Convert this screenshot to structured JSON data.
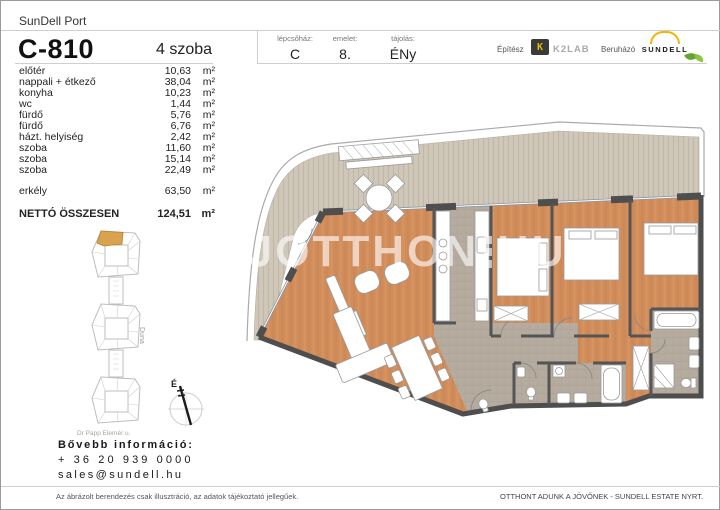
{
  "header": {
    "project": "SunDell Port",
    "unit_id": "C-810",
    "unit_type": "4 szoba",
    "meta": [
      {
        "label": "lépcsőház:",
        "value": "C"
      },
      {
        "label": "emelet:",
        "value": "8."
      },
      {
        "label": "tájolás:",
        "value": "ÉNy"
      }
    ],
    "architect_label": "Építész",
    "architect_glyph": "K",
    "architect_name": "K2LAB",
    "developer_label": "Beruházó",
    "developer_name": "SUNDELL"
  },
  "rooms": {
    "items": [
      {
        "name": "előtér",
        "area": "10,63",
        "unit": "m²"
      },
      {
        "name": "nappali + étkező",
        "area": "38,04",
        "unit": "m²"
      },
      {
        "name": "konyha",
        "area": "10,23",
        "unit": "m²"
      },
      {
        "name": "wc",
        "area": "1,44",
        "unit": "m²"
      },
      {
        "name": "fürdő",
        "area": "5,76",
        "unit": "m²"
      },
      {
        "name": "fürdő",
        "area": "6,76",
        "unit": "m²"
      },
      {
        "name": "házt. helyiség",
        "area": "2,42",
        "unit": "m²"
      },
      {
        "name": "szoba",
        "area": "11,60",
        "unit": "m²"
      },
      {
        "name": "szoba",
        "area": "15,14",
        "unit": "m²"
      },
      {
        "name": "szoba",
        "area": "22,49",
        "unit": "m²"
      }
    ],
    "balcony": {
      "name": "erkély",
      "area": "63,50",
      "unit": "m²"
    },
    "total": {
      "name": "NETTÓ ÖSSZESEN",
      "area": "124,51",
      "unit": "m²"
    }
  },
  "site_plan": {
    "river_label": "Duna",
    "street_label": "Dr Papp Elemér u.",
    "compass_label": "É",
    "highlight_color": "#d9a24e"
  },
  "contact": {
    "heading": "Bővebb információ:",
    "phone": "+ 36 20 939 0000",
    "email": "sales@sundell.hu"
  },
  "footer": {
    "disclaimer": "Az ábrázolt berendezés csak illusztráció, az adatok tájékoztató jellegűek.",
    "tagline": "OTTHONT ADUNK A JÖVŐNEK - SUNDELL ESTATE NYRT."
  },
  "watermark": {
    "left": "UJOTTHON",
    "right": "HU"
  },
  "plan_colors": {
    "wood_floor": "#d08c5a",
    "tile_floor": "#b5ab9e",
    "deck": "#cfc7b9",
    "wall": "#4e4e4e"
  }
}
